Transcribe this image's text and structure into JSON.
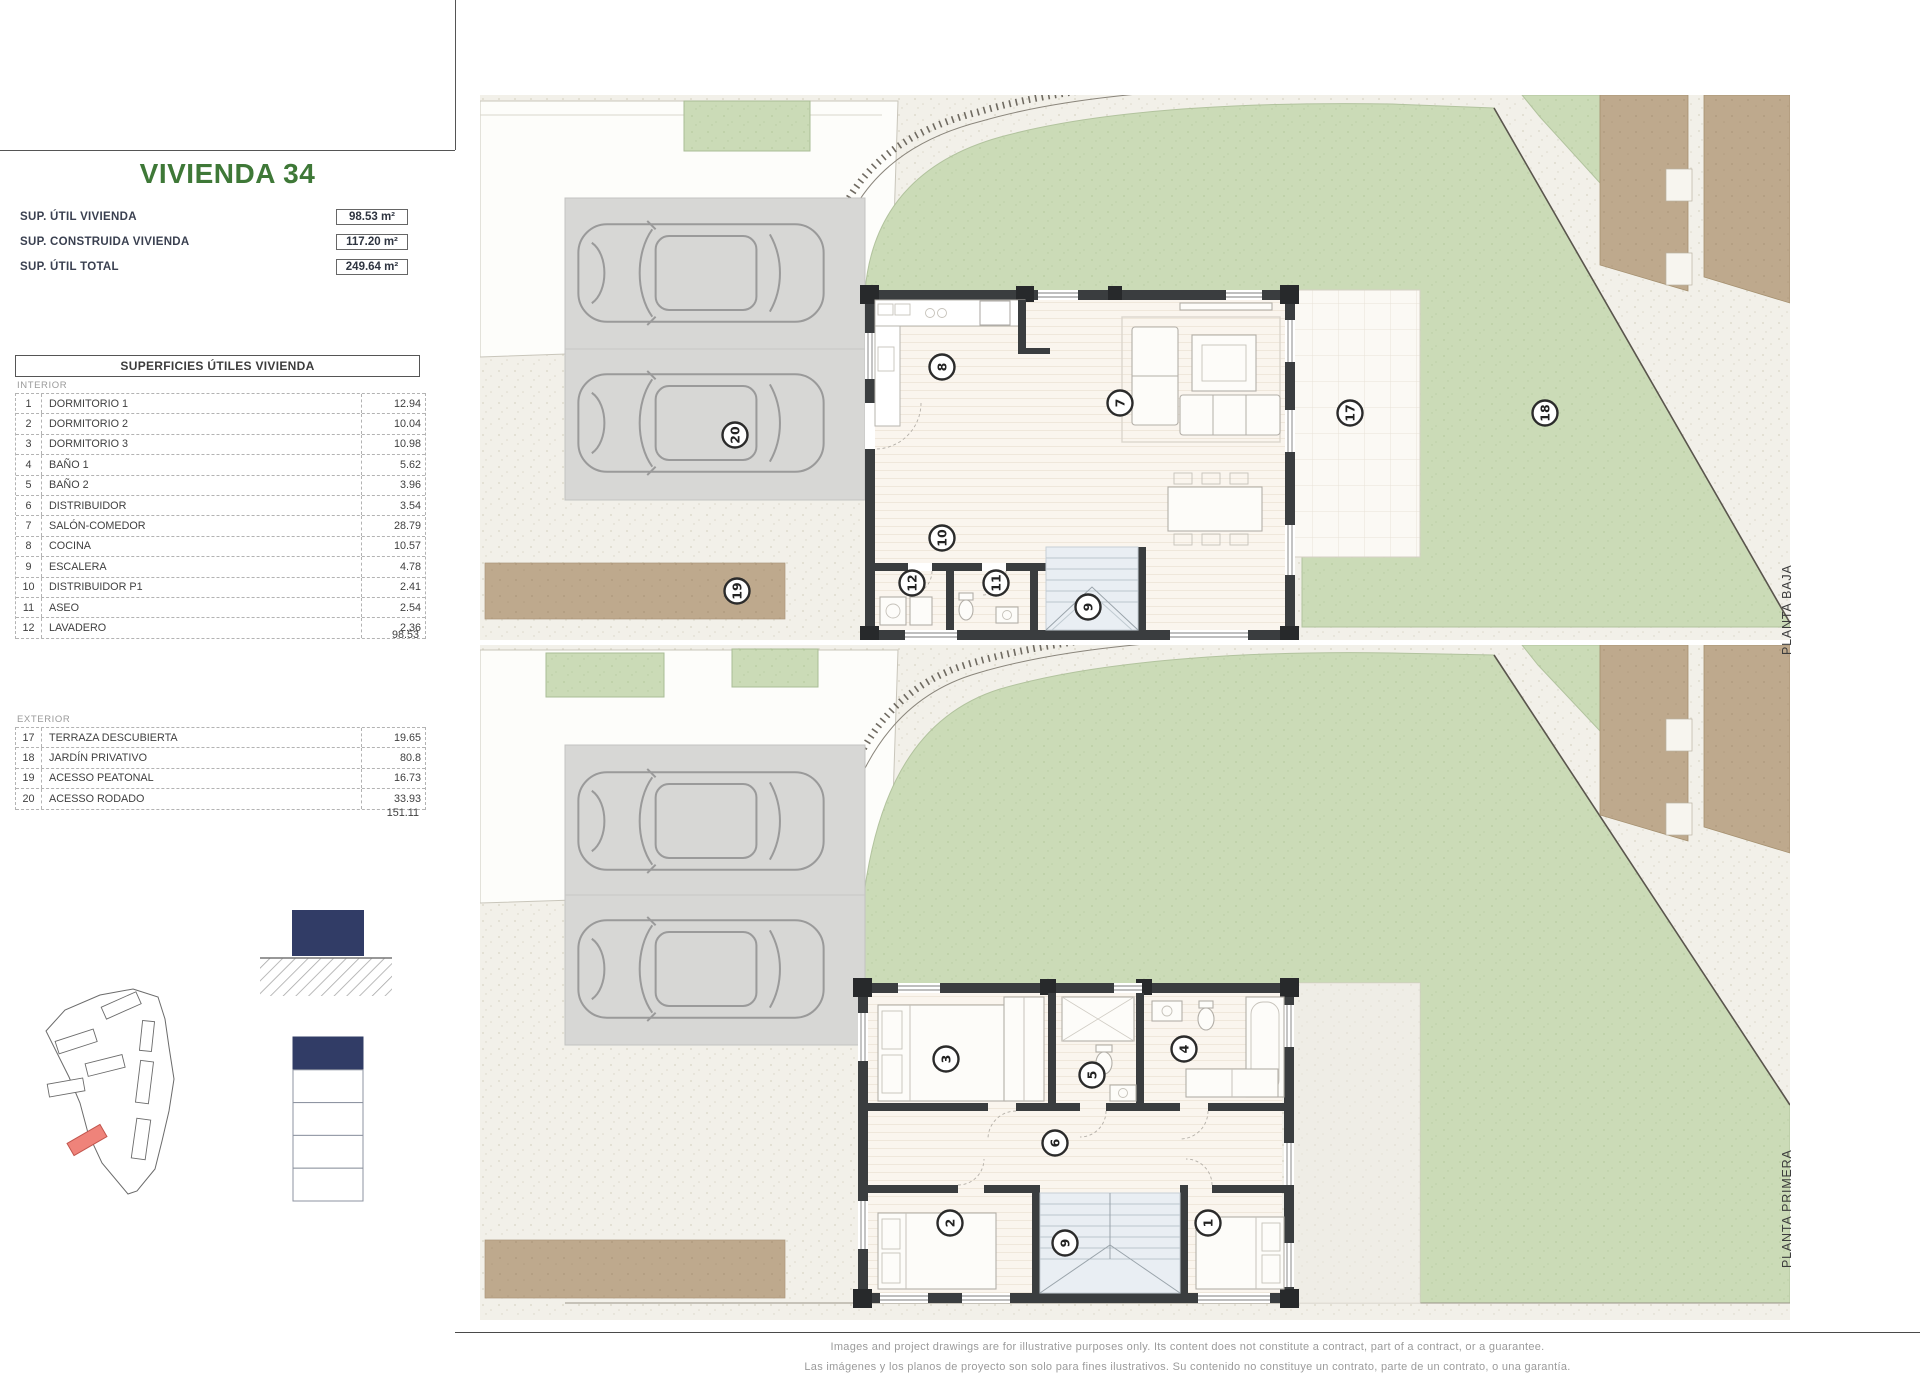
{
  "title": "VIVIENDA 34",
  "summary": [
    {
      "label": "SUP. ÚTIL VIVIENDA",
      "value": "98.53 m²"
    },
    {
      "label": "SUP. CONSTRUIDA VIVIENDA",
      "value": "117.20 m²"
    },
    {
      "label": "SUP. ÚTIL TOTAL",
      "value": "249.64 m²"
    }
  ],
  "areas_table": {
    "header": "SUPERFICIES ÚTILES VIVIENDA",
    "interior_label": "INTERIOR",
    "interior": [
      {
        "num": "1",
        "name": "DORMITORIO 1",
        "value": "12.94"
      },
      {
        "num": "2",
        "name": "DORMITORIO 2",
        "value": "10.04"
      },
      {
        "num": "3",
        "name": "DORMITORIO 3",
        "value": "10.98"
      },
      {
        "num": "4",
        "name": "BAÑO 1",
        "value": "5.62"
      },
      {
        "num": "5",
        "name": "BAÑO 2",
        "value": "3.96"
      },
      {
        "num": "6",
        "name": "DISTRIBUIDOR",
        "value": "3.54"
      },
      {
        "num": "7",
        "name": "SALÓN-COMEDOR",
        "value": "28.79"
      },
      {
        "num": "8",
        "name": "COCINA",
        "value": "10.57"
      },
      {
        "num": "9",
        "name": "ESCALERA",
        "value": "4.78"
      },
      {
        "num": "10",
        "name": "DISTRIBUIDOR P1",
        "value": "2.41"
      },
      {
        "num": "11",
        "name": "ASEO",
        "value": "2.54"
      },
      {
        "num": "12",
        "name": "LAVADERO",
        "value": "2.36"
      }
    ],
    "interior_total": "98.53",
    "exterior_label": "EXTERIOR",
    "exterior": [
      {
        "num": "17",
        "name": "TERRAZA DESCUBIERTA",
        "value": "19.65"
      },
      {
        "num": "18",
        "name": "JARDÍN PRIVATIVO",
        "value": "80.8"
      },
      {
        "num": "19",
        "name": "ACESSO PEATONAL",
        "value": "16.73"
      },
      {
        "num": "20",
        "name": "ACESSO RODADO",
        "value": "33.93"
      }
    ],
    "exterior_total": "151.11"
  },
  "plans": {
    "baja_label": "PLANTA BAJA",
    "primera_label": "PLANTA PRIMERA"
  },
  "markers": {
    "pb": {
      "cocina": "8",
      "salon": "7",
      "distribuidor": "10",
      "lavadero": "12",
      "aseo": "11",
      "escalera": "9",
      "terraza": "17",
      "jardin": "18",
      "peatonal": "19",
      "rodado": "20"
    },
    "p1": {
      "dorm1": "1",
      "dorm2": "2",
      "dorm3": "3",
      "bano1": "4",
      "bano2": "5",
      "distribuidor": "6",
      "escalera": "9"
    }
  },
  "footer": {
    "line_en": "Images and project drawings are for illustrative purposes only. Its content does not constitute a contract, part of a contract, or a guarantee.",
    "line_es": "Las imágenes y los planos de proyecto son solo para fines ilustrativos. Su contenido no constituye un contrato, parte de un contrato, o una garantía."
  },
  "colors": {
    "accent_green": "#3e7837",
    "navy": "#313c66",
    "highlight_red": "#ef837a",
    "garden_green": "#cbdbb7",
    "path_brown": "#bea98d",
    "parking_gray": "#d7d7d5",
    "wall_dark": "#3a3d3f"
  }
}
